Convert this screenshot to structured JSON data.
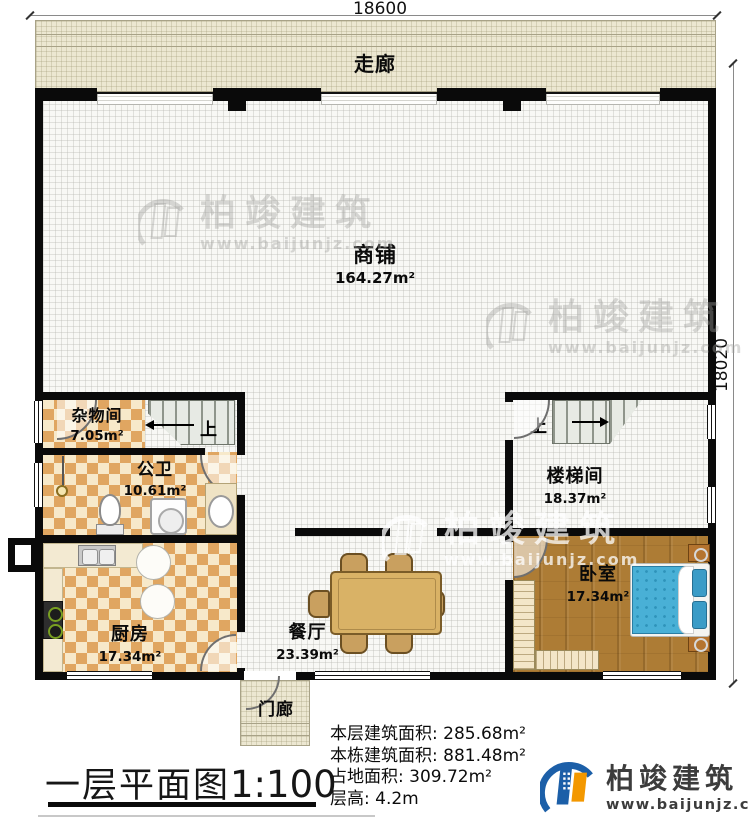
{
  "dimensions": {
    "width_label": "18600",
    "height_label": "18020"
  },
  "rooms": {
    "corridor": {
      "label": "走廊"
    },
    "shop": {
      "label": "商铺",
      "area": "164.27m²"
    },
    "storage": {
      "label": "杂物间",
      "area": "7.05m²"
    },
    "bathroom": {
      "label": "公卫",
      "area": "10.61m²"
    },
    "kitchen": {
      "label": "厨房",
      "area": "17.34m²"
    },
    "dining": {
      "label": "餐厅",
      "area": "23.39m²"
    },
    "stairwell": {
      "label": "楼梯间",
      "area": "18.37m²"
    },
    "bedroom": {
      "label": "卧室",
      "area": "17.34m²"
    },
    "porch": {
      "label": "门廊"
    }
  },
  "stairs": {
    "left_up": "上",
    "right_up": "上"
  },
  "stats": {
    "rows": [
      {
        "label": "本层建筑面积:",
        "value": "285.68m²"
      },
      {
        "label": "本栋建筑面积:",
        "value": "881.48m²"
      },
      {
        "label": "占地面积:",
        "value": "309.72m²"
      },
      {
        "label": "层高:",
        "value": "4.2m"
      }
    ]
  },
  "title": {
    "text": "一层平面图",
    "scale": "1:100"
  },
  "brand": {
    "name": "柏竣建筑",
    "url": "www.baijunjz.com"
  },
  "watermark": {
    "name": "柏竣建筑",
    "url": "www.baijunjz.com"
  },
  "colors": {
    "wall": "#0a0a0a",
    "corridor_floor": "#ece7d1",
    "tile_light": "#f7e9ca",
    "tile_dark": "#e0a661",
    "wood_floor": "#ad7c35",
    "bed_blue": "#49b0d6",
    "table_wood": "#d9b266",
    "logo_blue": "#1c5fa8",
    "logo_orange": "#f39800"
  }
}
